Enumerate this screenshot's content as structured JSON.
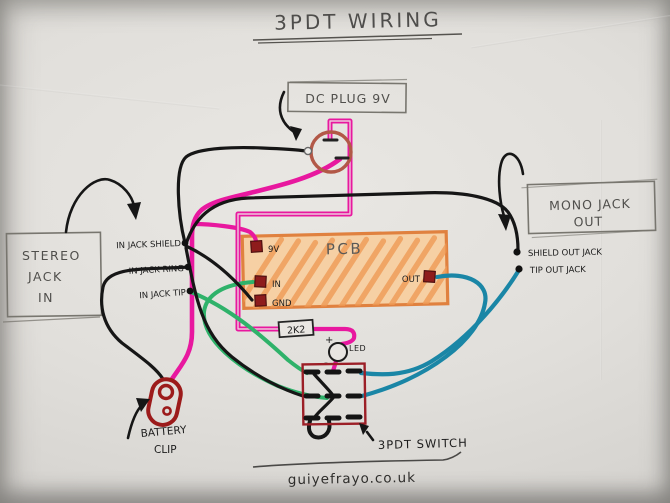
{
  "title": "3PDT WIRING",
  "boxes": {
    "dc_plug": "DC PLUG 9V",
    "mono_jack": {
      "line1": "MONO JACK",
      "line2": "OUT"
    },
    "stereo_jack": {
      "line1": "STEREO",
      "line2": "JACK",
      "line3": "IN"
    }
  },
  "pcb": {
    "label": "PCB",
    "pads": {
      "v9": "9V",
      "input": "IN",
      "gnd": "GND",
      "out": "OUT"
    }
  },
  "in_jack": {
    "shield": "IN JACK SHIELD",
    "ring": "IN JACK RING",
    "tip": "IN JACK TIP"
  },
  "out_jack": {
    "shield": "SHIELD OUT JACK",
    "tip": "TIP OUT JACK"
  },
  "components": {
    "resistor": "2K2",
    "led_label": "LED",
    "led_plus": "+",
    "led_minus": "-",
    "switch_label": "3PDT SWITCH",
    "battery_line1": "BATTERY",
    "battery_line2": "CLIP"
  },
  "footer": {
    "url": "guiyefrayo.co.uk"
  },
  "colors": {
    "ink": "#1c1c1c",
    "pencil": "#73716c",
    "magenta": "#e8189f",
    "green": "#2fb26a",
    "teal": "#1a86a6",
    "dark_red": "#9c1f27",
    "orange_fill": "#f6d0a4",
    "orange_stripe": "#ef9a55",
    "orange_border": "#e0813f",
    "brown": "#b25847",
    "paper": "#e0ded9"
  }
}
